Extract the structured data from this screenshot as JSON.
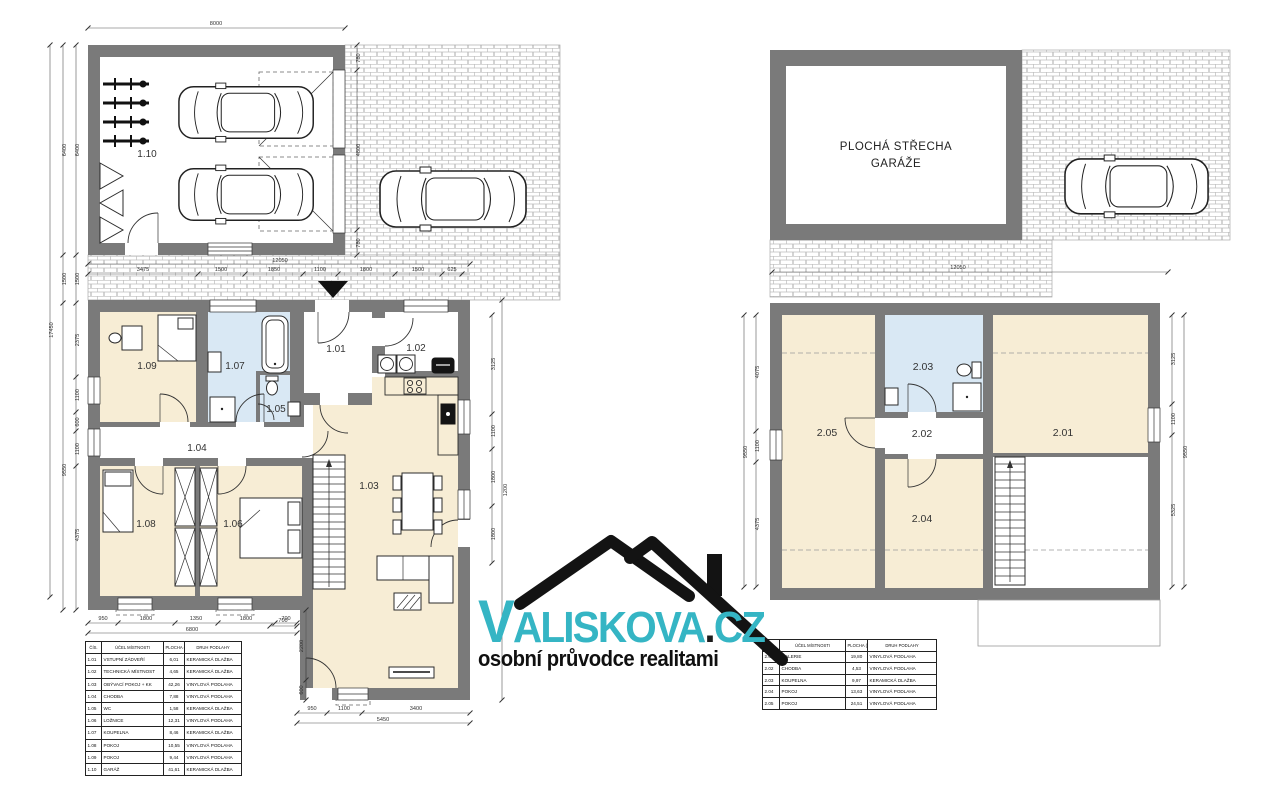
{
  "colors": {
    "wall": "#7a7a7a",
    "room_cream": "#f7edd5",
    "room_blue": "#d9e8f4",
    "brand_teal": "#35b5c4"
  },
  "watermark": {
    "v": "V",
    "rest": "ALISKOVA",
    "dot": ".",
    "tld": "CZ",
    "tagline": "osobní průvodce realitami"
  },
  "plan1": {
    "labels": {
      "r101": "1.01",
      "r102": "1.02",
      "r103": "1.03",
      "r104": "1.04",
      "r105": "1.05",
      "r106": "1.06",
      "r107": "1.07",
      "r108": "1.08",
      "r109": "1.09",
      "r110": "1.10"
    },
    "dims": {
      "top_total": "8000",
      "left_total": "17450",
      "left_mid": [
        "6400",
        "1500",
        "9550"
      ],
      "left_inner": [
        "6400",
        "1500",
        "2375",
        "1100",
        "600",
        "1100",
        "4375"
      ],
      "entry_row": [
        "3475",
        "1500",
        "1850",
        "1100",
        "1800",
        "1500",
        "625"
      ],
      "entry_row_total": "12050",
      "garage_right": [
        "780",
        "4800",
        "780"
      ],
      "right_chain": [
        "3125",
        "1100",
        "1800",
        "1800"
      ],
      "right_outer": "1200",
      "bottom_rooms": [
        "950",
        "1800",
        "1350",
        "1800",
        "700"
      ],
      "bottom_rooms_total": "6800",
      "bottom_living": [
        "950",
        "1100",
        "3400"
      ],
      "bottom_living_total": "5450",
      "living_left": [
        "700",
        "2200",
        "600"
      ]
    }
  },
  "plan2": {
    "roof_line1": "PLOCHÁ STŘECHA",
    "roof_line2": "GARÁŽE",
    "labels": {
      "r201": "2.01",
      "r202": "2.02",
      "r203": "2.03",
      "r204": "2.04",
      "r205": "2.05"
    },
    "dims": {
      "paving_total": "12050",
      "left_chain": [
        "4075",
        "1100",
        "4375"
      ],
      "left_total": "9550",
      "right_chain": [
        "3125",
        "1100",
        "5325"
      ],
      "right_total": "9550"
    }
  },
  "tables": {
    "floor1": {
      "headers": [
        "ČÍS.",
        "ÚČEL MÍSTNOSTI",
        "PLOCHA (m2)",
        "DRUH PODLAHY"
      ],
      "rows": [
        [
          "1.01",
          "VSTUPNÍ ZÁDVEŘÍ",
          "6,01",
          "KERAMICKÁ DLAŽBA"
        ],
        [
          "1.02",
          "TECHNICKÁ MÍSTNOST",
          "4,65",
          "KERAMICKÁ DLAŽBA"
        ],
        [
          "1.03",
          "OBÝVACÍ POKOJ + KK",
          "42,26",
          "VINYLOVÁ PODLAHA"
        ],
        [
          "1.04",
          "CHODBA",
          "7,88",
          "VINYLOVÁ PODLAHA"
        ],
        [
          "1.05",
          "WC",
          "1,58",
          "KERAMICKÁ DLAŽBA"
        ],
        [
          "1.06",
          "LOŽNICE",
          "12,31",
          "VINYLOVÁ PODLAHA"
        ],
        [
          "1.07",
          "KOUPELNA",
          "8,46",
          "KERAMICKÁ DLAŽBA"
        ],
        [
          "1.08",
          "POKOJ",
          "10,55",
          "VINYLOVÁ PODLAHA"
        ],
        [
          "1.09",
          "POKOJ",
          "9,44",
          "VINYLOVÁ PODLAHA"
        ],
        [
          "1.10",
          "GARÁŽ",
          "41,61",
          "KERAMICKÁ DLAŽBA"
        ]
      ]
    },
    "floor2": {
      "headers": [
        "ČÍS.",
        "ÚČEL MÍSTNOSTI",
        "PLOCHA (m2)",
        "DRUH PODLAHY"
      ],
      "rows": [
        [
          "2.01",
          "GALERIE",
          "19,80",
          "VINYLOVÁ PODLAHA"
        ],
        [
          "2.02",
          "CHODBA",
          "4,53",
          "VINYLOVÁ PODLAHA"
        ],
        [
          "2.03",
          "KOUPELNA",
          "9,97",
          "KERAMICKÁ DLAŽBA"
        ],
        [
          "2.04",
          "POKOJ",
          "13,63",
          "VINYLOVÁ PODLAHA"
        ],
        [
          "2.05",
          "POKOJ",
          "24,51",
          "VINYLOVÁ PODLAHA"
        ]
      ]
    }
  }
}
